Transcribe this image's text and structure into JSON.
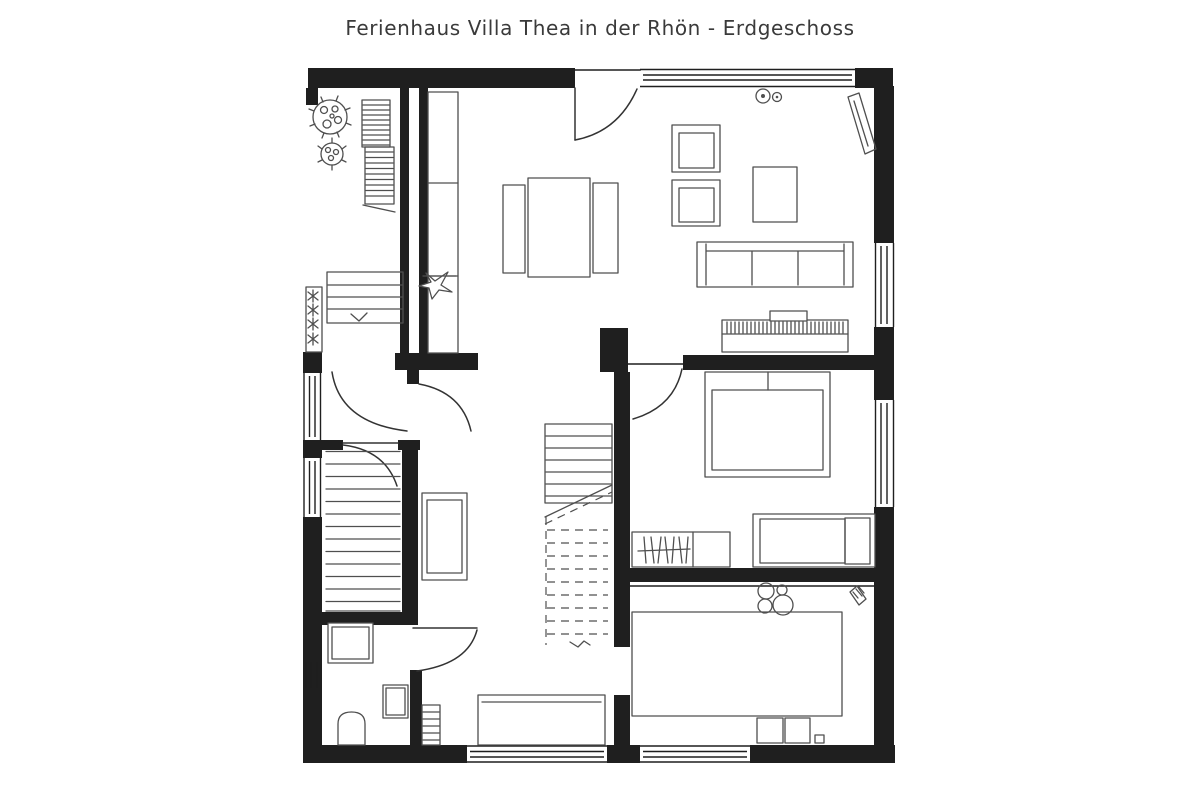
{
  "title": "Ferienhaus Villa Thea in der Rhön - Erdgeschoss",
  "colors": {
    "background": "#ffffff",
    "wall": "#1f1f1f",
    "line": "#4f4f4f",
    "door": "#333333",
    "title_text": "#3a3a3a"
  },
  "legend": {
    "drawing_type": "floor-plan",
    "floor": "Erdgeschoss"
  }
}
